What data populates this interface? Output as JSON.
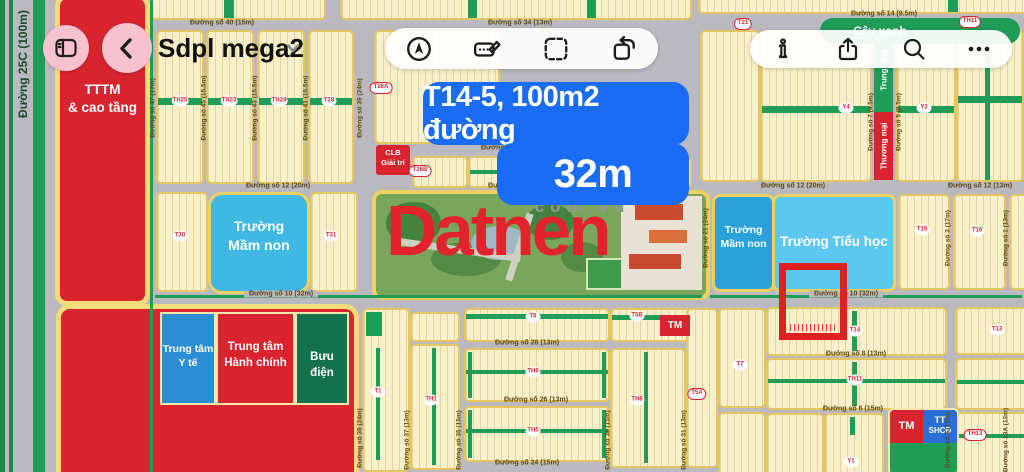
{
  "toolbar": {
    "title": "Sdpl mega2",
    "left_icons": [
      "sidebar",
      "back"
    ],
    "center_icons": [
      "navigate",
      "markup",
      "select",
      "rotate"
    ],
    "right_icons": [
      "info",
      "share",
      "search",
      "more"
    ]
  },
  "banner": {
    "line1": "T14-5, 100m2 đường",
    "line2": "32m"
  },
  "watermark": {
    "brand": "Datnen",
    "suffix": ".com.vn"
  },
  "colors": {
    "road": "#b9b9bf",
    "block_fill": "#f8f0ca",
    "block_border": "#e6c65e",
    "green": "#1f9d57",
    "red": "#d7242e",
    "banner_blue": "#1a6cf5",
    "brand_red": "#e3232b",
    "pink": "#f7c2cf",
    "cyan_light": "#5cc8ef",
    "cyan_mid": "#2aa2d9",
    "cyan_left": "#3fb9e4",
    "medical_blue": "#2b8ed2",
    "post_green": "#14704d",
    "highlight_red": "#e01f1f"
  },
  "map": {
    "road_label_25c": "Đường 25C (100m)",
    "features": {
      "tttm": "TTTM\n& cao tầng",
      "clb": "CLB\nGiải trí",
      "mamnon_left": "Trường\nMầm non",
      "mamnon_right": "Trường\nMầm non",
      "tieuhoc": "Trường Tiểu học",
      "thuongmai": "Thương mại",
      "trungtang": "Trung tầng",
      "yte": "Trung tâm\nY tế",
      "hanhchinh": "Trung tâm\nHành chính",
      "buudien": "Bưu điện",
      "tm_badge": "TM",
      "tm_small": "TM",
      "tt": "TT",
      "shcd": "SHCĐ",
      "cayxanh": "Cây xanh"
    },
    "street_labels": [
      {
        "text": "Đường số 40 (15m)",
        "x": 222,
        "y": 23
      },
      {
        "text": "Đường số 34 (13m)",
        "x": 520,
        "y": 23
      },
      {
        "text": "Đường số 14 (9.5m)",
        "x": 884,
        "y": 14
      },
      {
        "text": "Đường số 30 (13m)",
        "x": 513,
        "y": 148
      },
      {
        "text": "Đường số 12 (20m)",
        "x": 278,
        "y": 186
      },
      {
        "text": "Đường số 12 (20m)",
        "x": 520,
        "y": 186
      },
      {
        "text": "Đường số 12 (20m)",
        "x": 793,
        "y": 186
      },
      {
        "text": "Đường số 12 (13m)",
        "x": 980,
        "y": 186
      },
      {
        "text": "Đường số 10 (32m)",
        "x": 281,
        "y": 294,
        "bg": true
      },
      {
        "text": "Đường số 10 (32m)",
        "x": 846,
        "y": 294,
        "bg": true
      },
      {
        "text": "Đường số 28 (13m)",
        "x": 527,
        "y": 343
      },
      {
        "text": "Đường số 26 (13m)",
        "x": 536,
        "y": 400
      },
      {
        "text": "Đường số 24 (15m)",
        "x": 527,
        "y": 463
      },
      {
        "text": "Đường số 8 (13m)",
        "x": 856,
        "y": 354
      },
      {
        "text": "Đường số 6 (15m)",
        "x": 853,
        "y": 409
      },
      {
        "text": "Đường số 47 (17m)",
        "x": 153,
        "y": 108,
        "v": true
      },
      {
        "text": "Đường số 45 (15.5m)",
        "x": 204,
        "y": 108,
        "v": true
      },
      {
        "text": "Đường số 43 (15.5m)",
        "x": 255,
        "y": 108,
        "v": true
      },
      {
        "text": "Đường số 41 (15.5m)",
        "x": 306,
        "y": 108,
        "v": true
      },
      {
        "text": "Đường số 39 (24m)",
        "x": 360,
        "y": 108,
        "v": true
      },
      {
        "text": "Đường số 7 (9.5m)",
        "x": 871,
        "y": 122,
        "v": true
      },
      {
        "text": "Đường số 5 (9.5m)",
        "x": 899,
        "y": 122,
        "v": true
      },
      {
        "text": "Đường số 21 (24m)",
        "x": 706,
        "y": 238,
        "v": true
      },
      {
        "text": "Đường số 3 (17m)",
        "x": 948,
        "y": 238,
        "v": true
      },
      {
        "text": "Đường số 1 (13m)",
        "x": 1006,
        "y": 238,
        "v": true
      },
      {
        "text": "Đường số 39 (24m)",
        "x": 360,
        "y": 438,
        "v": true
      },
      {
        "text": "Đường số 37 (13m)",
        "x": 407,
        "y": 440,
        "v": true
      },
      {
        "text": "Đường số 35 (15m)",
        "x": 459,
        "y": 440,
        "v": true
      },
      {
        "text": "Đường số 33 (15m)",
        "x": 608,
        "y": 440,
        "v": true
      },
      {
        "text": "Đường số 31 (13m)",
        "x": 684,
        "y": 440,
        "v": true
      },
      {
        "text": "Đường số 3 (17m)",
        "x": 948,
        "y": 440,
        "v": true
      },
      {
        "text": "Đường số 13A (13m)",
        "x": 1006,
        "y": 440,
        "v": true
      }
    ],
    "plot_labels_circle": [
      {
        "text": "TH25",
        "x": 180,
        "y": 101
      },
      {
        "text": "TH23",
        "x": 229,
        "y": 101
      },
      {
        "text": "TH24",
        "x": 279,
        "y": 101
      },
      {
        "text": "T28",
        "x": 329,
        "y": 101
      },
      {
        "text": "T27",
        "x": 537,
        "y": 171
      },
      {
        "text": "T30",
        "x": 180,
        "y": 236
      },
      {
        "text": "T31",
        "x": 331,
        "y": 236
      },
      {
        "text": "Y4",
        "x": 846,
        "y": 108
      },
      {
        "text": "Y2",
        "x": 924,
        "y": 108
      },
      {
        "text": "T15",
        "x": 922,
        "y": 230
      },
      {
        "text": "T16",
        "x": 977,
        "y": 231
      },
      {
        "text": "T1",
        "x": 378,
        "y": 392
      },
      {
        "text": "TH1",
        "x": 431,
        "y": 400
      },
      {
        "text": "T6",
        "x": 533,
        "y": 317
      },
      {
        "text": "TH6",
        "x": 533,
        "y": 372
      },
      {
        "text": "TH5",
        "x": 533,
        "y": 431
      },
      {
        "text": "T5B",
        "x": 637,
        "y": 316
      },
      {
        "text": "TH8",
        "x": 637,
        "y": 400
      },
      {
        "text": "T7",
        "x": 740,
        "y": 365
      },
      {
        "text": "T14",
        "x": 855,
        "y": 331
      },
      {
        "text": "TH11",
        "x": 855,
        "y": 380
      },
      {
        "text": "Y1",
        "x": 851,
        "y": 462
      },
      {
        "text": "T13",
        "x": 997,
        "y": 330
      }
    ],
    "plot_labels_oval": [
      {
        "text": "T26A",
        "x": 381,
        "y": 88
      },
      {
        "text": "T26B",
        "x": 420,
        "y": 171
      },
      {
        "text": "T21",
        "x": 743,
        "y": 24
      },
      {
        "text": "TH11",
        "x": 970,
        "y": 22
      },
      {
        "text": "T5A",
        "x": 697,
        "y": 394
      },
      {
        "text": "TH13",
        "x": 975,
        "y": 435
      }
    ]
  }
}
